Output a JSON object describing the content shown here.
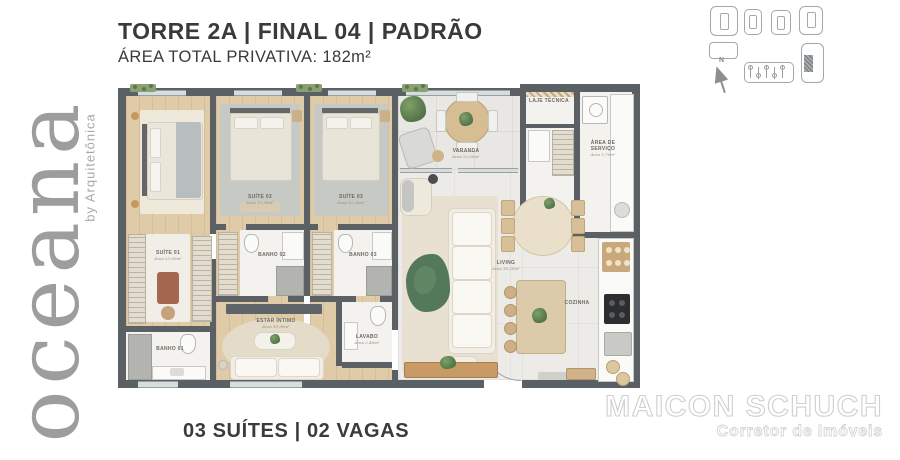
{
  "header": {
    "title": "TORRE 2A | FINAL 04 | PADRÃO",
    "subtitle": "ÁREA TOTAL PRIVATIVA: 182m²"
  },
  "brand": {
    "name": "oceana",
    "byline": "by Arquitetônica"
  },
  "keyplan": {
    "compass_label": "N",
    "icons": [
      "unit-keyplan-1",
      "unit-keyplan-2",
      "unit-keyplan-3",
      "unit-keyplan-4",
      "compass-north",
      "floor-strip-keyplan",
      "unit-highlight"
    ]
  },
  "floorplan": {
    "rooms": [
      {
        "id": "suite-01",
        "label": "SUÍTE 01",
        "area": "Área 23,00m²"
      },
      {
        "id": "banho-01",
        "label": "BANHO 01",
        "area": ""
      },
      {
        "id": "suite-02",
        "label": "SUÍTE 02",
        "area": "Área 12,30m²"
      },
      {
        "id": "banho-02",
        "label": "BANHO 02",
        "area": ""
      },
      {
        "id": "suite-03",
        "label": "SUÍTE 03",
        "area": "Área 12,30m²"
      },
      {
        "id": "banho-03",
        "label": "BANHO 03",
        "area": ""
      },
      {
        "id": "estar-intimo",
        "label": "ESTAR ÍNTIMO",
        "area": "Área 10,90m²"
      },
      {
        "id": "lavabo",
        "label": "LAVABO",
        "area": "Área 2,40m²"
      },
      {
        "id": "varanda",
        "label": "VARANDA",
        "area": "Área 22,00m²"
      },
      {
        "id": "living",
        "label": "LIVING",
        "area": "Área 30,20m²"
      },
      {
        "id": "cozinha",
        "label": "COZINHA",
        "area": ""
      },
      {
        "id": "area-servico",
        "label": "ÁREA DE SERVIÇO",
        "area": "Área 5,70m²"
      },
      {
        "id": "laje-tecnica",
        "label": "LAJE TÉCNICA",
        "area": ""
      }
    ]
  },
  "footer": {
    "caption": "03 SUÍTES | 02 VAGAS"
  },
  "watermark": {
    "name": "MAICON SCHUCH",
    "role": "Corretor de Imóveis"
  },
  "colors": {
    "wall": "#5b6064",
    "wood_floor": "#e0cba8",
    "tile_floor": "#edebe7",
    "accent_green": "#527549",
    "logo_gray": "#9d9d9d",
    "text": "#3a3a3a",
    "watermark_stroke": "#cfcfcf"
  }
}
